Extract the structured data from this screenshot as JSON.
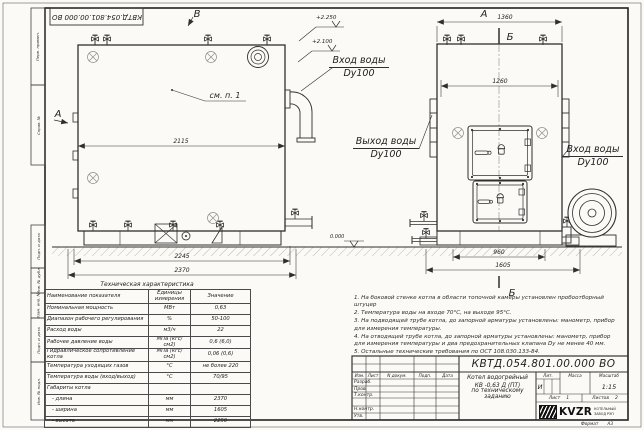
{
  "doc": {
    "number": "КВТД.054.801.00.000  ВО",
    "number_top": "КВТД.054.801.00.000 ВО"
  },
  "sidebar_labels": [
    "Перв. примен.",
    "Справ. №",
    "Подп. и дата",
    "Инв. № дубл.",
    "Взам. инв. №",
    "Подп. и дата",
    "Инв. № подл."
  ],
  "side_view": {
    "letter_top": "В",
    "letter_left": "А",
    "callout": "см. п. 1",
    "elev_1": "+2.250",
    "elev_2": "+2.100",
    "dim_width": "2115",
    "dim_base": "2245",
    "dim_length": "2370",
    "inlet_line1": "Вход воды",
    "inlet_line2": "Dy100"
  },
  "front_view": {
    "letter_top": "А",
    "section_top": "Б",
    "section_bottom": "Б",
    "dim_top": "1360",
    "dim_flange": "1260",
    "dim_base": "960",
    "dim_width": "1605",
    "elev_zero": "0.000",
    "outlet_line1": "Выход воды",
    "outlet_line2": "Dy100",
    "inlet_line1": "Вход воды",
    "inlet_line2": "Dy100"
  },
  "tech_table": {
    "title": "Техническая характеристика",
    "col_name": "Наименование показателя",
    "col_unit": "Единицы измерения",
    "col_value": "Значение",
    "rows": [
      {
        "name": "Номинальная мощность",
        "unit": "МВт",
        "value": "0,63"
      },
      {
        "name": "Диапазон рабочего регулирования",
        "unit": "%",
        "value": "50-100"
      },
      {
        "name": "Расход воды",
        "unit": "м3/ч",
        "value": "22"
      },
      {
        "name": "Рабочее давление воды",
        "unit": "МПа (кгс/см2)",
        "value": "0,6 (6,0)"
      },
      {
        "name": "Гидравлическое сопротивление котла",
        "unit": "МПа (кгс/см2)",
        "value": "0,06 (0,6)"
      },
      {
        "name": "Температура уходящих газов",
        "unit": "°С",
        "value": "не более 220"
      },
      {
        "name": "Температура воды (вход/выход)",
        "unit": "°С",
        "value": "70/95"
      },
      {
        "name": "Габариты котла",
        "unit": "",
        "value": ""
      },
      {
        "name": "- длина",
        "unit": "мм",
        "value": "2370"
      },
      {
        "name": "- ширина",
        "unit": "мм",
        "value": "1605"
      },
      {
        "name": "- высота",
        "unit": "мм",
        "value": "2250"
      }
    ]
  },
  "notes": [
    "1. На боковой стенке котла в области топочной камеры установлен пробоотборный штуцер",
    "2. Температура воды на входе 70°С, на выходе 95°С.",
    "3. На подводящей трубе котла, до запорной арматуры установлены: манометр, прибор для измерения температуры.",
    "4. На отводящей трубе котла, до запорной арматуры установлены: манометр, прибор для измерения температуры и два предохранительных клапана Dy не менее 40 мм.",
    "5. Остальные технические требования по ОСТ 108.030.133-84."
  ],
  "title_block": {
    "headers": [
      "Изм.",
      "Лист",
      "N докум.",
      "Подп.",
      "Дата"
    ],
    "roles": [
      "Разраб.",
      "Пров.",
      "Т.контр.",
      "Н.контр.",
      "Утв."
    ],
    "product_line1": "Котел водогрейный",
    "product_line2": "КВ -0,63  Д  (ПТ)",
    "product_line3": "по техническому заданию",
    "lit_label": "Лит.",
    "mass_label": "Масса",
    "scale_label": "Масштаб",
    "lit_value": "И",
    "scale_value": "1:15",
    "sheet_label": "Лист",
    "sheet_value": "1",
    "sheets_label": "Листов",
    "sheets_value": "2",
    "logo_text": "KVZR",
    "logo_sub1": "КОТЕЛЬНЫЙ",
    "logo_sub2": "ЗАВОД РЭП",
    "format_label": "Формат",
    "format_value": "А3"
  }
}
